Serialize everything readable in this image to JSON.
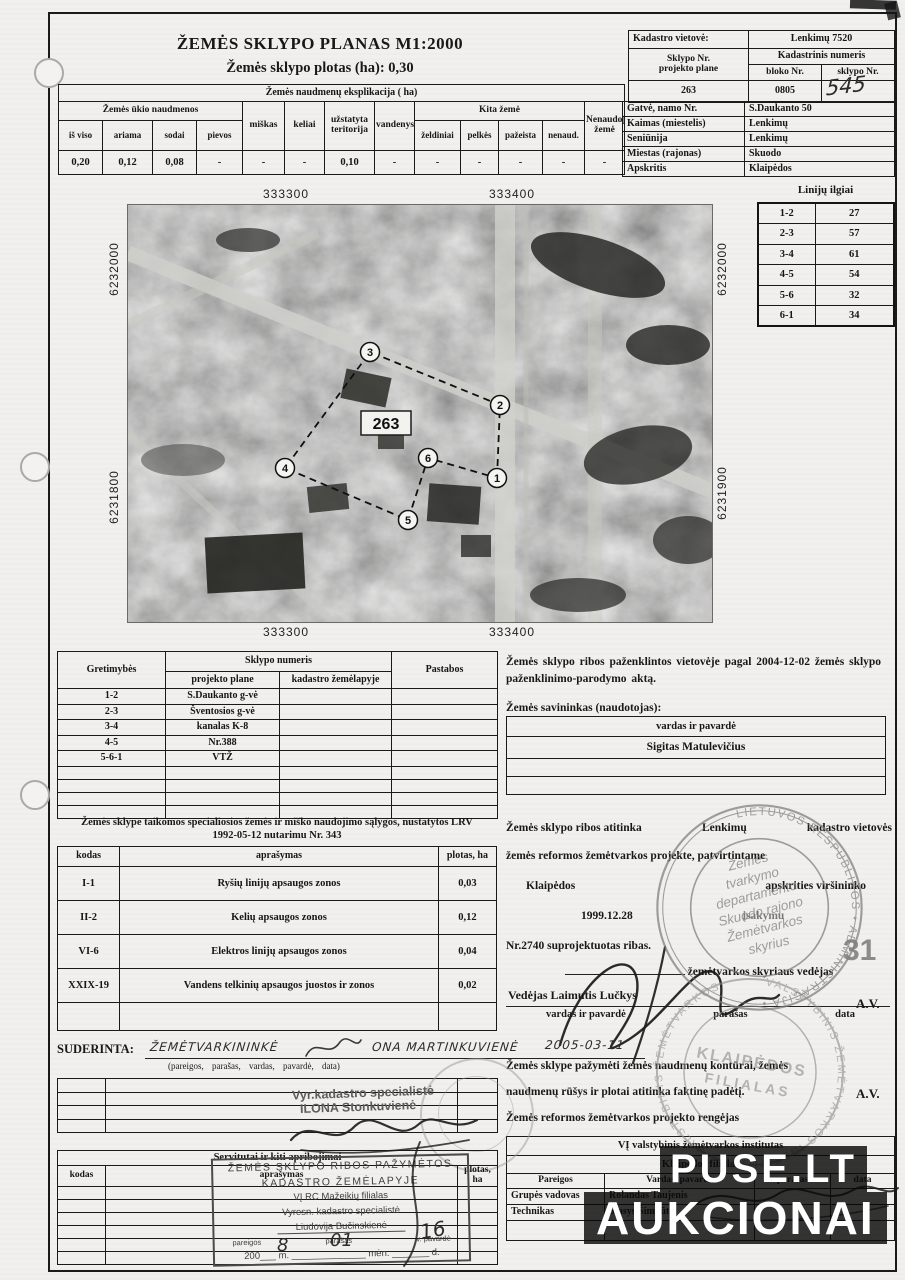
{
  "header": {
    "title": "ŽEMĖS SKLYPO PLANAS M1:2000",
    "subtitle": "Žemės sklypo plotas (ha): 0,30"
  },
  "explication": {
    "title": "Žemės naudmenų eksplikacija ( ha)",
    "group_agri": "Žemės ūkio naudmenos",
    "col_total": "iš viso",
    "col_arable": "ariama",
    "col_gardens": "sodai",
    "col_meadows": "pievos",
    "col_forest": "miškas",
    "col_roads": "keliai",
    "col_builtup": "užstatyta teritorija",
    "col_water": "vandenys",
    "group_other": "Kita žemė",
    "col_green": "želdiniai",
    "col_swamps": "pelkės",
    "col_damaged": "pažeista",
    "col_unused": "nenaud.",
    "col_notused": "Nenaudojama žemė",
    "values": [
      "0,20",
      "0,12",
      "0,08",
      "-",
      "-",
      "-",
      "0,10",
      "-",
      "-",
      "-",
      "-",
      "-",
      "-"
    ]
  },
  "cadastre": {
    "loc_label": "Kadastro vietovė:",
    "loc_value": "Lenkimų 7520",
    "plot_label": "Sklypo Nr.",
    "plot_label2": "projekto plane",
    "cad_label": "Kadastrinis numeris",
    "block_label": "bloko Nr.",
    "sk_label": "sklypo Nr.",
    "plot_no": "263",
    "block_no": "0805",
    "sk_no_handwritten": "545",
    "rows": [
      {
        "label": "Gatvė, namo Nr.",
        "value": "S.Daukanto 50"
      },
      {
        "label": "Kaimas (miestelis)",
        "value": "Lenkimų"
      },
      {
        "label": "Seniūnija",
        "value": "Lenkimų"
      },
      {
        "label": "Miestas (rajonas)",
        "value": "Skuodo"
      },
      {
        "label": "Apskritis",
        "value": "Klaipėdos"
      }
    ]
  },
  "map": {
    "coord_top_left": "333300",
    "coord_top_right": "333400",
    "coord_bottom_left": "333300",
    "coord_bottom_right": "333400",
    "coord_left_top": "6232000",
    "coord_left_bottom": "6231800",
    "coord_right_top": "6232000",
    "coord_right_bottom": "6231900",
    "plot_number": "263",
    "points": [
      "1",
      "2",
      "3",
      "4",
      "5",
      "6"
    ]
  },
  "lines_table": {
    "title": "Linijų ilgiai",
    "rows": [
      [
        "1-2",
        "27"
      ],
      [
        "2-3",
        "57"
      ],
      [
        "3-4",
        "61"
      ],
      [
        "4-5",
        "54"
      ],
      [
        "5-6",
        "32"
      ],
      [
        "6-1",
        "34"
      ]
    ]
  },
  "gretimybes": {
    "col_adjacency": "Gretimybės",
    "col_plot": "Sklypo numeris",
    "col_project": "projekto plane",
    "col_cadmap": "kadastro žemėlapyje",
    "col_notes": "Pastabos",
    "rows": [
      [
        "1-2",
        "S.Daukanto g-vė"
      ],
      [
        "2-3",
        "Šventosios g-vė"
      ],
      [
        "3-4",
        "kanalas K-8"
      ],
      [
        "4-5",
        "Nr.388"
      ],
      [
        "5-6-1",
        "VTŽ"
      ]
    ]
  },
  "marking": {
    "text": "Žemės sklypo ribos paženklintos vietovėje pagal 2004-12-02 žemės sklypo paženklinimo-parodymo aktą.",
    "owner_label": "Žemės savininkas (naudotojas):",
    "owner_col": "vardas ir pavardė",
    "owner_name": "Sigitas Matulevičius"
  },
  "conditions": {
    "title1": "Žemės sklype taikomos specialiosios žemės ir miško naudojimo sąlygos, nustatytos LRV",
    "title2": "1992-05-12 nutarimu  Nr. 343",
    "col_code": "kodas",
    "col_desc": "aprašymas",
    "col_area": "plotas, ha",
    "rows": [
      [
        "I-1",
        "Ryšių linijų apsaugos zonos",
        "0,03"
      ],
      [
        "II-2",
        "Kelių apsaugos zonos",
        "0,12"
      ],
      [
        "VI-6",
        "Elektros linijų apsaugos zonos",
        "0,04"
      ],
      [
        "XXIX-19",
        "Vandens telkinių apsaugos juostos ir zonos",
        "0,02"
      ]
    ]
  },
  "boundaries": {
    "l1a": "Žemės sklypo ribos atitinka",
    "l1b": "Lenkimų",
    "l1c": "kadastro vietovės",
    "l2": "žemės reformos žemėtvarkos projekte, patvirtintame",
    "l3a": "Klaipėdos",
    "l3b": "apskrities viršininko",
    "l4a": "1999.12.28",
    "l4b": "įsakymu",
    "l5": "Nr.2740  suprojektuotas ribas.",
    "dept": "žemėtvarkos skyriaus vedėjas",
    "head": "Vedėjas Laimutis Lučkys",
    "cap1": "vardas ir pavardė",
    "cap2": "parašas",
    "cap3": "data",
    "av": "A.V.",
    "corner_number": "31"
  },
  "accuracy": {
    "l1": "Žemės sklype pažymėti žemės naudmenų kontūrai, žemės",
    "l2": "naudmenų rūšys ir plotai atitinka faktinę padėtį.",
    "av": "A.V.",
    "l3": "Žemės reformos žemėtvarkos projekto rengėjas"
  },
  "institute": {
    "title1": "VĮ valstybinis žemėtvarkos institutas",
    "title2": "Klaipėdos  filialas",
    "col_role": "Pareigos",
    "col_name": "Vardas, pavardė",
    "col_sign": "parašas",
    "col_date": "data",
    "rows": [
      [
        "Grupės vadovas",
        "Rolandas Taujenis"
      ],
      [
        "Technikas",
        "Stasys Šimkūta"
      ]
    ]
  },
  "suderinta": {
    "label": "SUDERINTA:",
    "hw_role": "ŽEMĖTVARKININKĖ",
    "hw_name": "ONA MARTINKUVIENĖ",
    "hw_date": "2005-03-11",
    "caption": "(pareigos,      parašas,      vardas, pavardė,      data)"
  },
  "specialist_stamp": {
    "line1": "Vyr.kadastro specialistė",
    "line2": "ILONA Stonkuvienė"
  },
  "servitutai": {
    "title": "Servitutai ir kiti apribojimai",
    "col_code": "kodas",
    "col_desc": "aprašymas",
    "col_area": "plotas, ha"
  },
  "box_stamp": {
    "l1": "ŽEMĖS SKLYPO RIBOS PAŽYMĖTOS",
    "l2": "KADASTRO ŽEMĖLAPYJE",
    "l3": "VĮ RC Mažeikių filialas",
    "l4": "Vyresn. kadastro specialistė",
    "l5": "Liudovija Bučinskienė",
    "cap1": "pareigos",
    "cap2": "parašas",
    "cap3": "v. pavardė",
    "date_line": "200___ m. ______________ mėn. _______ d.",
    "hw_year": "8",
    "hw_month": "01",
    "hw_day": "16"
  },
  "stamp_skuodo": {
    "ring": "LIETUVOS RESPUBLIKOS • ADMINISTRACIJA •",
    "l1": "Žemės",
    "l2": "tvarkymo",
    "l3": "departamento",
    "l4": "Skuodo rajono",
    "l5": "Žemėtvarkos",
    "l6": "skyrius"
  },
  "stamp_klaipeda": {
    "ring": "VALSTYBINIS ŽEMĖTVARKOS INSTITUTAS  •  VALSTYBINIS ŽEMĖTVARKOS",
    "inner1": "KLAIPĖDOS",
    "inner2": "FILIALAS"
  },
  "watermark": {
    "line1": "PUSE.LT",
    "line2": "AUKCIONAI"
  }
}
